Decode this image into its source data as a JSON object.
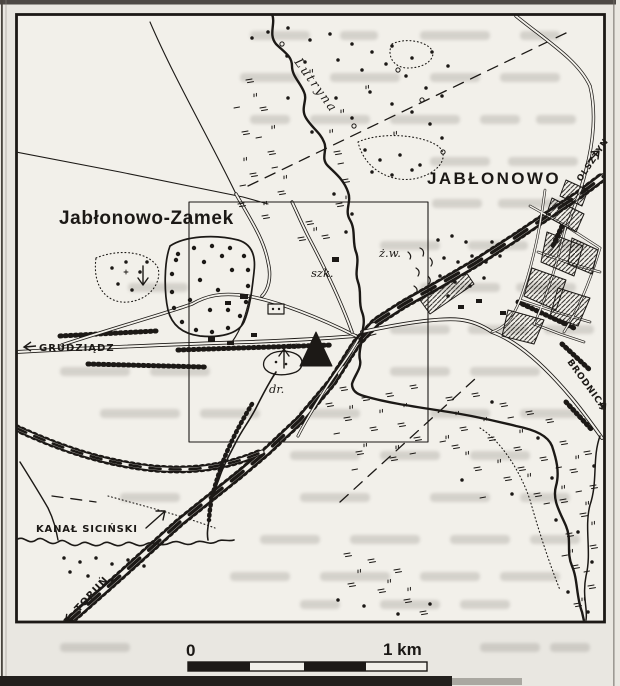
{
  "figure": {
    "towns": {
      "jablonowo": "JABŁONOWO",
      "jablonowo_zamek": "Jabłonowo-Zamek"
    },
    "hydro": {
      "river": "Lutryna",
      "canal": "KANAŁ SICIŃSKI"
    },
    "abbrevs": {
      "school": "szk.",
      "gravel_pit": "ż.w.",
      "road": "dr.",
      "spot_height": "16"
    },
    "directions": {
      "grudziadz": "GRUDZIĄDZ",
      "torun": "TORUŃ",
      "olsztyn": "OLSZTYN",
      "brodnica": "BRODNICA"
    },
    "scale_bar": {
      "zero": "0",
      "end": "1 km"
    },
    "colors": {
      "ink": "#1c1916",
      "paper": "#f2f0ea",
      "margin": "#e6e3dd"
    }
  }
}
